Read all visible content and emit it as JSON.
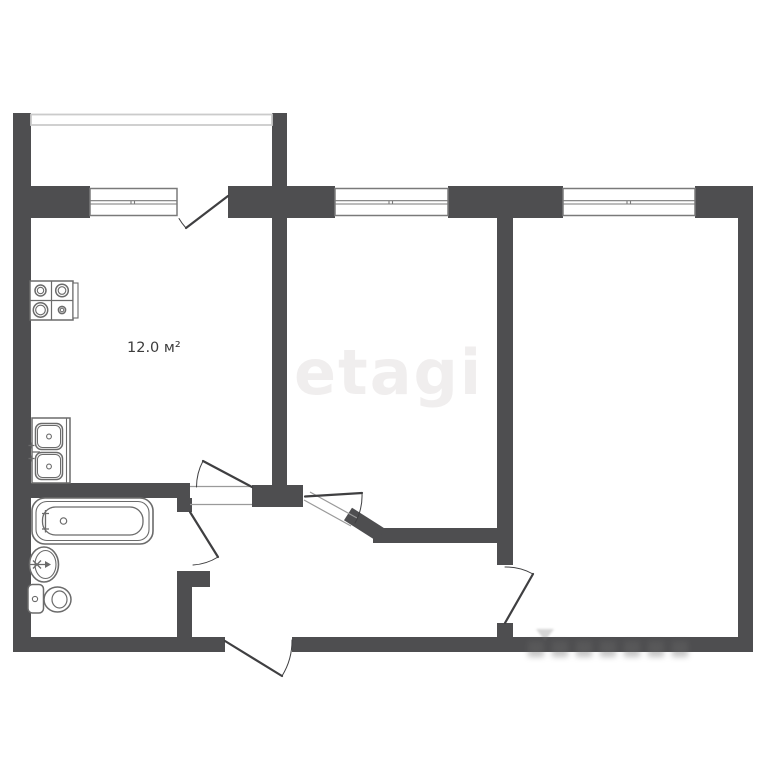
{
  "labels": {
    "kitchen_area": "12.0 м²"
  },
  "watermark": {
    "brand": "etagi"
  },
  "colors": {
    "wall": "#4e4e50",
    "door": "#3f3f41",
    "window_frame": "#7a7a7a",
    "parapet": "#cbcbcb",
    "fixture": "#6b6b6b",
    "threshold": "#9a9a9a",
    "label": "#3c3c3c",
    "watermark": "#f0eeee",
    "background": "#ffffff"
  },
  "icons": {
    "stove": "stove-icon",
    "kitchen_sink": "kitchen-sink-icon",
    "bathtub": "bathtub-icon",
    "washbasin": "washbasin-icon",
    "toilet": "toilet-icon"
  }
}
